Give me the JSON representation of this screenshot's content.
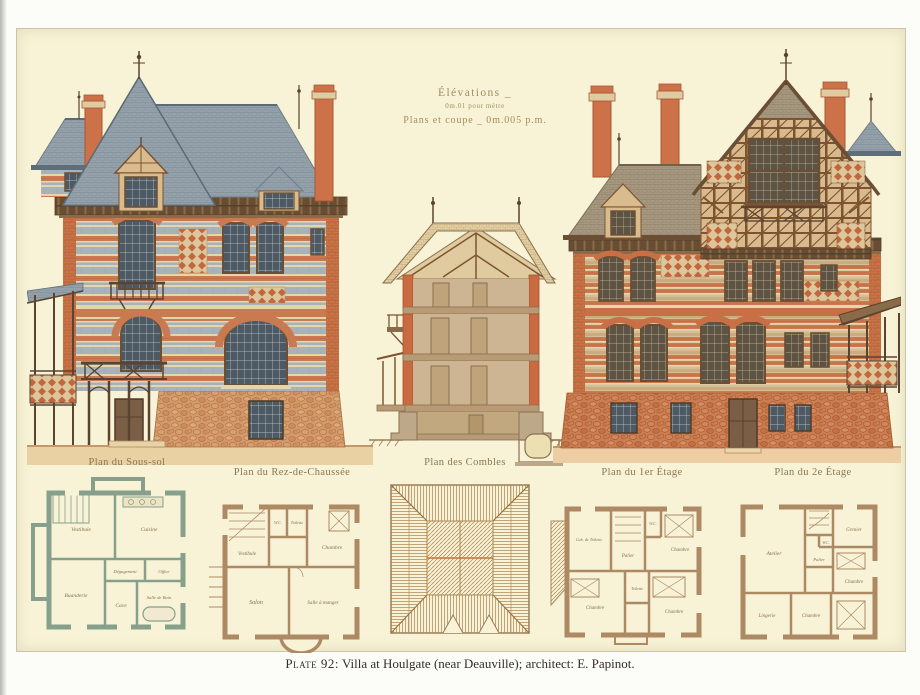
{
  "plate": {
    "caption_prefix": "Plate 92:",
    "caption_rest": "Villa at Houlgate (near Deauville); architect: E. Papinot."
  },
  "annotations": {
    "line1": "Élévations _",
    "line2": "0m.01 pour mètre",
    "line3": "Plans et coupe _ 0m.005 p.m."
  },
  "plans": [
    {
      "label": "Plan du Sous-sol",
      "rooms": {
        "vestibule": "Vestibule",
        "cuisine": "Cuisine",
        "buanderie": "Buanderie",
        "degagement": "Dégagement",
        "office": "Office",
        "cave": "Cave",
        "salle_de_bain": "Salle de Bain"
      }
    },
    {
      "label": "Plan du Rez-de-Chaussée",
      "rooms": {
        "vestibule": "Vestibule",
        "wc": "W.C.",
        "toilette": "Toilette",
        "chambre": "Chambre",
        "salon": "Salon",
        "salle_a_manger": "Salle à manger"
      }
    },
    {
      "label": "Plan des Combles",
      "rooms": {}
    },
    {
      "label": "Plan du 1er Étage",
      "rooms": {
        "cab_toilette": "Cab. de Toilette",
        "palier": "Palier",
        "wc": "W.C.",
        "toilette": "Toilette",
        "chambre1": "Chambre",
        "chambre2": "Chambre",
        "chambre3": "Chambre"
      }
    },
    {
      "label": "Plan du 2e Étage",
      "rooms": {
        "atelier": "Atelier",
        "grenier": "Grenier",
        "palier": "Palier",
        "wc": "W.C.",
        "chambre1": "Chambre",
        "chambre2": "Chambre",
        "lingerie": "Lingerie"
      }
    }
  ],
  "colors": {
    "plate_background": "#f8f3d6",
    "brick_orange": "#c97a50",
    "slate_blue_gray": "#93a0a9",
    "roof_brown": "#a2937d",
    "stone_base": "#d49a6b",
    "ground_band": "#e9d1a3",
    "timber_brown": "#5a4330",
    "plan_wall_green": "#87a08c",
    "plan_wall_brown": "#ad8a64",
    "label_ink": "#8b7650",
    "caption_ink": "#332e26"
  }
}
